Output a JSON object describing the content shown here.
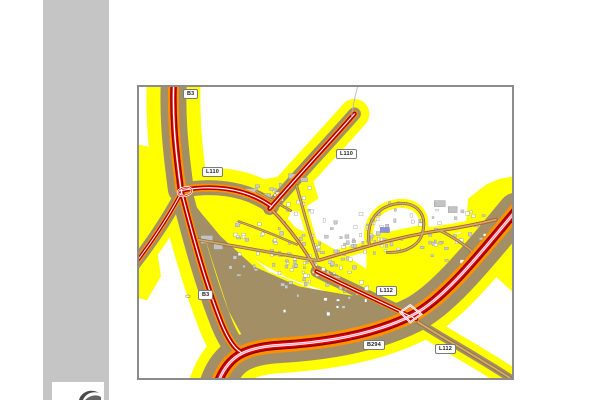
{
  "page": {
    "background": "#ffffff"
  },
  "sidebar": {
    "background": "#c5c5c5"
  },
  "logo": {
    "color": "#4a4a4a"
  },
  "map": {
    "frame_color": "#8c8c8c",
    "road_labels": [
      {
        "id": "b3-north",
        "text": "B3"
      },
      {
        "id": "l110-northeast",
        "text": "L110"
      },
      {
        "id": "l110-west",
        "text": "L110"
      },
      {
        "id": "l112-center",
        "text": "L112"
      },
      {
        "id": "b3-south",
        "text": "B3"
      },
      {
        "id": "b294",
        "text": "B294"
      },
      {
        "id": "l112-southeast",
        "text": "L112"
      }
    ],
    "colors": {
      "yellow": "#ffff00",
      "olive": "#a28f66",
      "orange": "#ff9000",
      "red": "#e00000",
      "darkred": "#8f0000",
      "pink": "#eeaac8",
      "road_casing": "#96713f",
      "road_fill": "#d4ab6a",
      "main_casing": "#aa5a30",
      "building": "#cccccc",
      "building_outline": "#8f8f8f",
      "blue_building": "#8f8fe0",
      "sidebar": "#c5c5c5",
      "frame": "#8c8c8c"
    }
  }
}
